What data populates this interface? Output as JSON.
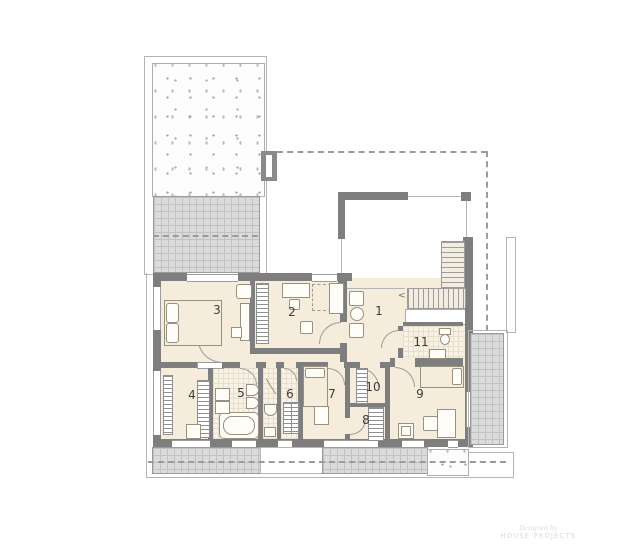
{
  "title": "floor-plan-upper-storey",
  "rooms": [
    {
      "number": "1"
    },
    {
      "number": "2"
    },
    {
      "number": "3"
    },
    {
      "number": "4"
    },
    {
      "number": "5"
    },
    {
      "number": "6"
    },
    {
      "number": "7"
    },
    {
      "number": "8"
    },
    {
      "number": "9"
    },
    {
      "number": "10"
    },
    {
      "number": "11"
    }
  ],
  "stairs": {
    "arrow": "<"
  },
  "watermark": {
    "line1": "Designed by",
    "line2": "HOUSE PROJECTS"
  },
  "colors": {
    "wall": "#7e7e7e",
    "floor": "#f6ecdb",
    "terrace": "#dbdbdb",
    "line": "#9b9b9b"
  }
}
